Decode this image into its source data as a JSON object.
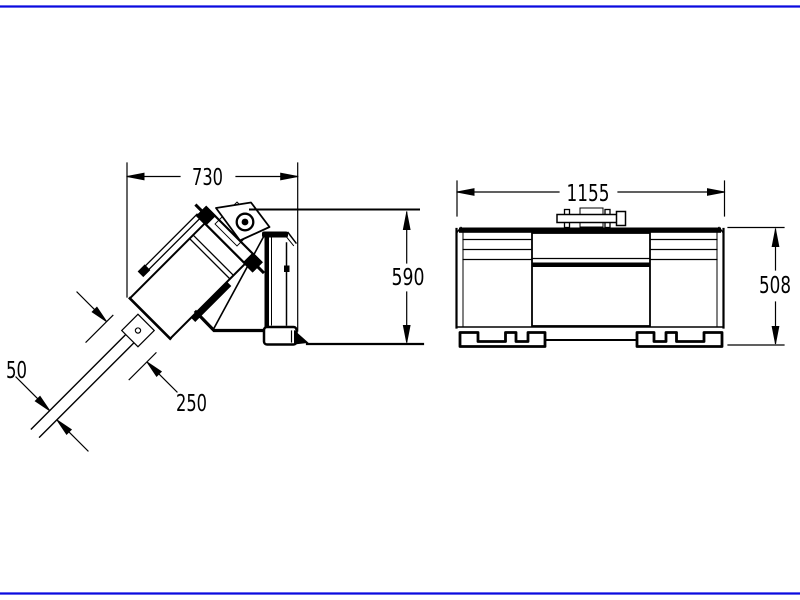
{
  "drawing": {
    "background_color": "#ffffff",
    "line_color": "#000000",
    "frame_color": "#0a0adf",
    "side_view": {
      "name": "auger drive side view",
      "dim_width": "730",
      "dim_height": "590",
      "dim_housing": "250",
      "dim_shaft": "50"
    },
    "front_view": {
      "name": "mounting frame front view",
      "dim_width": "1155",
      "dim_height": "508"
    }
  }
}
